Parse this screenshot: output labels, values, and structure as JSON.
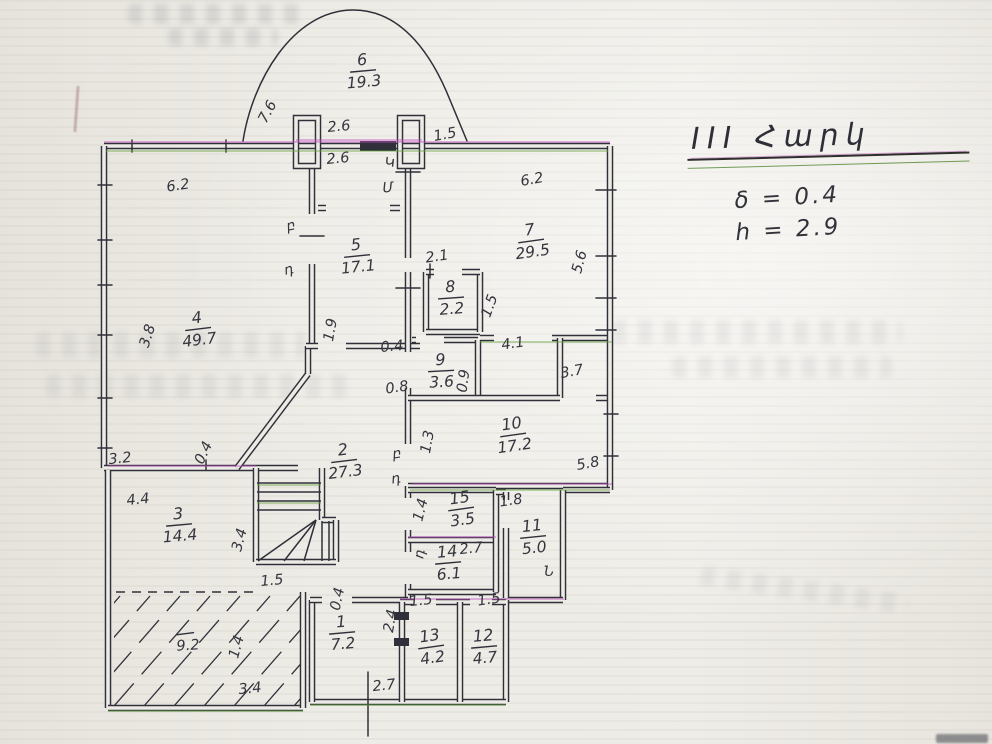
{
  "title_block": {
    "floor_title": "III Հարկ",
    "wall_thickness": "δ = 0.4",
    "height_note": "h = 2.9"
  },
  "colors": {
    "ink": "#30303a",
    "paper": "#edebe5",
    "fringe_magenta": "#c050c0",
    "fringe_green": "#64a23e"
  },
  "plan": {
    "rooms": [
      {
        "num": "1",
        "area": "7.2",
        "x": 342,
        "y": 632,
        "rot": -5
      },
      {
        "num": "2",
        "area": "27.3",
        "x": 344,
        "y": 460,
        "rot": -7
      },
      {
        "num": "3",
        "area": "14.4",
        "x": 179,
        "y": 524,
        "rot": -5
      },
      {
        "num": "4",
        "area": "49.7",
        "x": 198,
        "y": 328,
        "rot": -7
      },
      {
        "num": "5",
        "area": "17.1",
        "x": 357,
        "y": 255,
        "rot": -6
      },
      {
        "num": "6",
        "area": "19.3",
        "x": 363,
        "y": 70,
        "rot": -5
      },
      {
        "num": "7",
        "area": "29.5",
        "x": 531,
        "y": 240,
        "rot": -8
      },
      {
        "num": "8",
        "area": "2.2",
        "x": 451,
        "y": 297,
        "rot": -4
      },
      {
        "num": "9",
        "area": "3.6",
        "x": 441,
        "y": 370,
        "rot": -3
      },
      {
        "num": "10",
        "area": "17.2",
        "x": 513,
        "y": 434,
        "rot": -8
      },
      {
        "num": "11",
        "area": "5.0",
        "x": 533,
        "y": 536,
        "rot": -6
      },
      {
        "num": "12",
        "area": "4.7",
        "x": 484,
        "y": 646,
        "rot": -5
      },
      {
        "num": "13",
        "area": "4.2",
        "x": 431,
        "y": 646,
        "rot": -8
      },
      {
        "num": "14",
        "area": "6.1",
        "x": 448,
        "y": 562,
        "rot": -5
      },
      {
        "num": "15",
        "area": "3.5",
        "x": 461,
        "y": 508,
        "rot": -8
      }
    ],
    "dims": [
      {
        "text": "7.6",
        "x": 268,
        "y": 112,
        "rot": -62
      },
      {
        "text": "2.6",
        "x": 339,
        "y": 127,
        "rot": -5
      },
      {
        "text": "2.6",
        "x": 338,
        "y": 159,
        "rot": -5
      },
      {
        "text": "1.5",
        "x": 445,
        "y": 135,
        "rot": -10
      },
      {
        "text": "6.2",
        "x": 178,
        "y": 186,
        "rot": -8
      },
      {
        "text": "6.2",
        "x": 532,
        "y": 180,
        "rot": -10
      },
      {
        "text": "2.1",
        "x": 437,
        "y": 257,
        "rot": -8
      },
      {
        "text": "1.5",
        "x": 490,
        "y": 306,
        "rot": -70
      },
      {
        "text": "0.4",
        "x": 392,
        "y": 347,
        "rot": -5
      },
      {
        "text": "0.8",
        "x": 397,
        "y": 388,
        "rot": -8
      },
      {
        "text": "0.9",
        "x": 464,
        "y": 381,
        "rot": -82
      },
      {
        "text": "4.1",
        "x": 513,
        "y": 344,
        "rot": -8
      },
      {
        "text": "3.7",
        "x": 572,
        "y": 372,
        "rot": -10
      },
      {
        "text": "5.6",
        "x": 580,
        "y": 262,
        "rot": -75
      },
      {
        "text": "5.8",
        "x": 588,
        "y": 464,
        "rot": -10
      },
      {
        "text": "3.8",
        "x": 148,
        "y": 336,
        "rot": -72
      },
      {
        "text": "1.9",
        "x": 331,
        "y": 330,
        "rot": -80
      },
      {
        "text": "3.2",
        "x": 120,
        "y": 459,
        "rot": -6
      },
      {
        "text": "0.4",
        "x": 204,
        "y": 453,
        "rot": -65
      },
      {
        "text": "4.4",
        "x": 138,
        "y": 500,
        "rot": -6
      },
      {
        "text": "3.4",
        "x": 240,
        "y": 540,
        "rot": -75
      },
      {
        "text": "1.5",
        "x": 272,
        "y": 581,
        "rot": -5
      },
      {
        "text": "9.2",
        "x": 188,
        "y": 646,
        "rot": -4,
        "bar": true
      },
      {
        "text": "1.4",
        "x": 237,
        "y": 647,
        "rot": -75
      },
      {
        "text": "3.4",
        "x": 250,
        "y": 689,
        "rot": -6
      },
      {
        "text": "1.3",
        "x": 428,
        "y": 442,
        "rot": -80
      },
      {
        "text": "2.7",
        "x": 471,
        "y": 549,
        "rot": -6
      },
      {
        "text": "1.8",
        "x": 511,
        "y": 501,
        "rot": -8
      },
      {
        "text": "1.4",
        "x": 421,
        "y": 510,
        "rot": -76
      },
      {
        "text": "0.4",
        "x": 338,
        "y": 599,
        "rot": -78
      },
      {
        "text": "2.4",
        "x": 391,
        "y": 621,
        "rot": -80
      },
      {
        "text": "1.5",
        "x": 421,
        "y": 601,
        "rot": -6
      },
      {
        "text": "1.5",
        "x": 489,
        "y": 600,
        "rot": -8
      },
      {
        "text": "2.7",
        "x": 384,
        "y": 686,
        "rot": -6
      }
    ],
    "marks": [
      {
        "text": "բ",
        "x": 291,
        "y": 226,
        "rot": -12
      },
      {
        "text": "դ",
        "x": 289,
        "y": 270,
        "rot": -12
      },
      {
        "text": "Կ",
        "x": 390,
        "y": 163,
        "rot": -5
      },
      {
        "text": "Մ",
        "x": 388,
        "y": 188,
        "rot": -5
      },
      {
        "text": "բ",
        "x": 397,
        "y": 454,
        "rot": -8
      },
      {
        "text": "դ",
        "x": 396,
        "y": 479,
        "rot": -8
      },
      {
        "text": "դ",
        "x": 420,
        "y": 554,
        "rot": -80
      },
      {
        "text": "Ն",
        "x": 549,
        "y": 572,
        "rot": 0
      }
    ]
  }
}
